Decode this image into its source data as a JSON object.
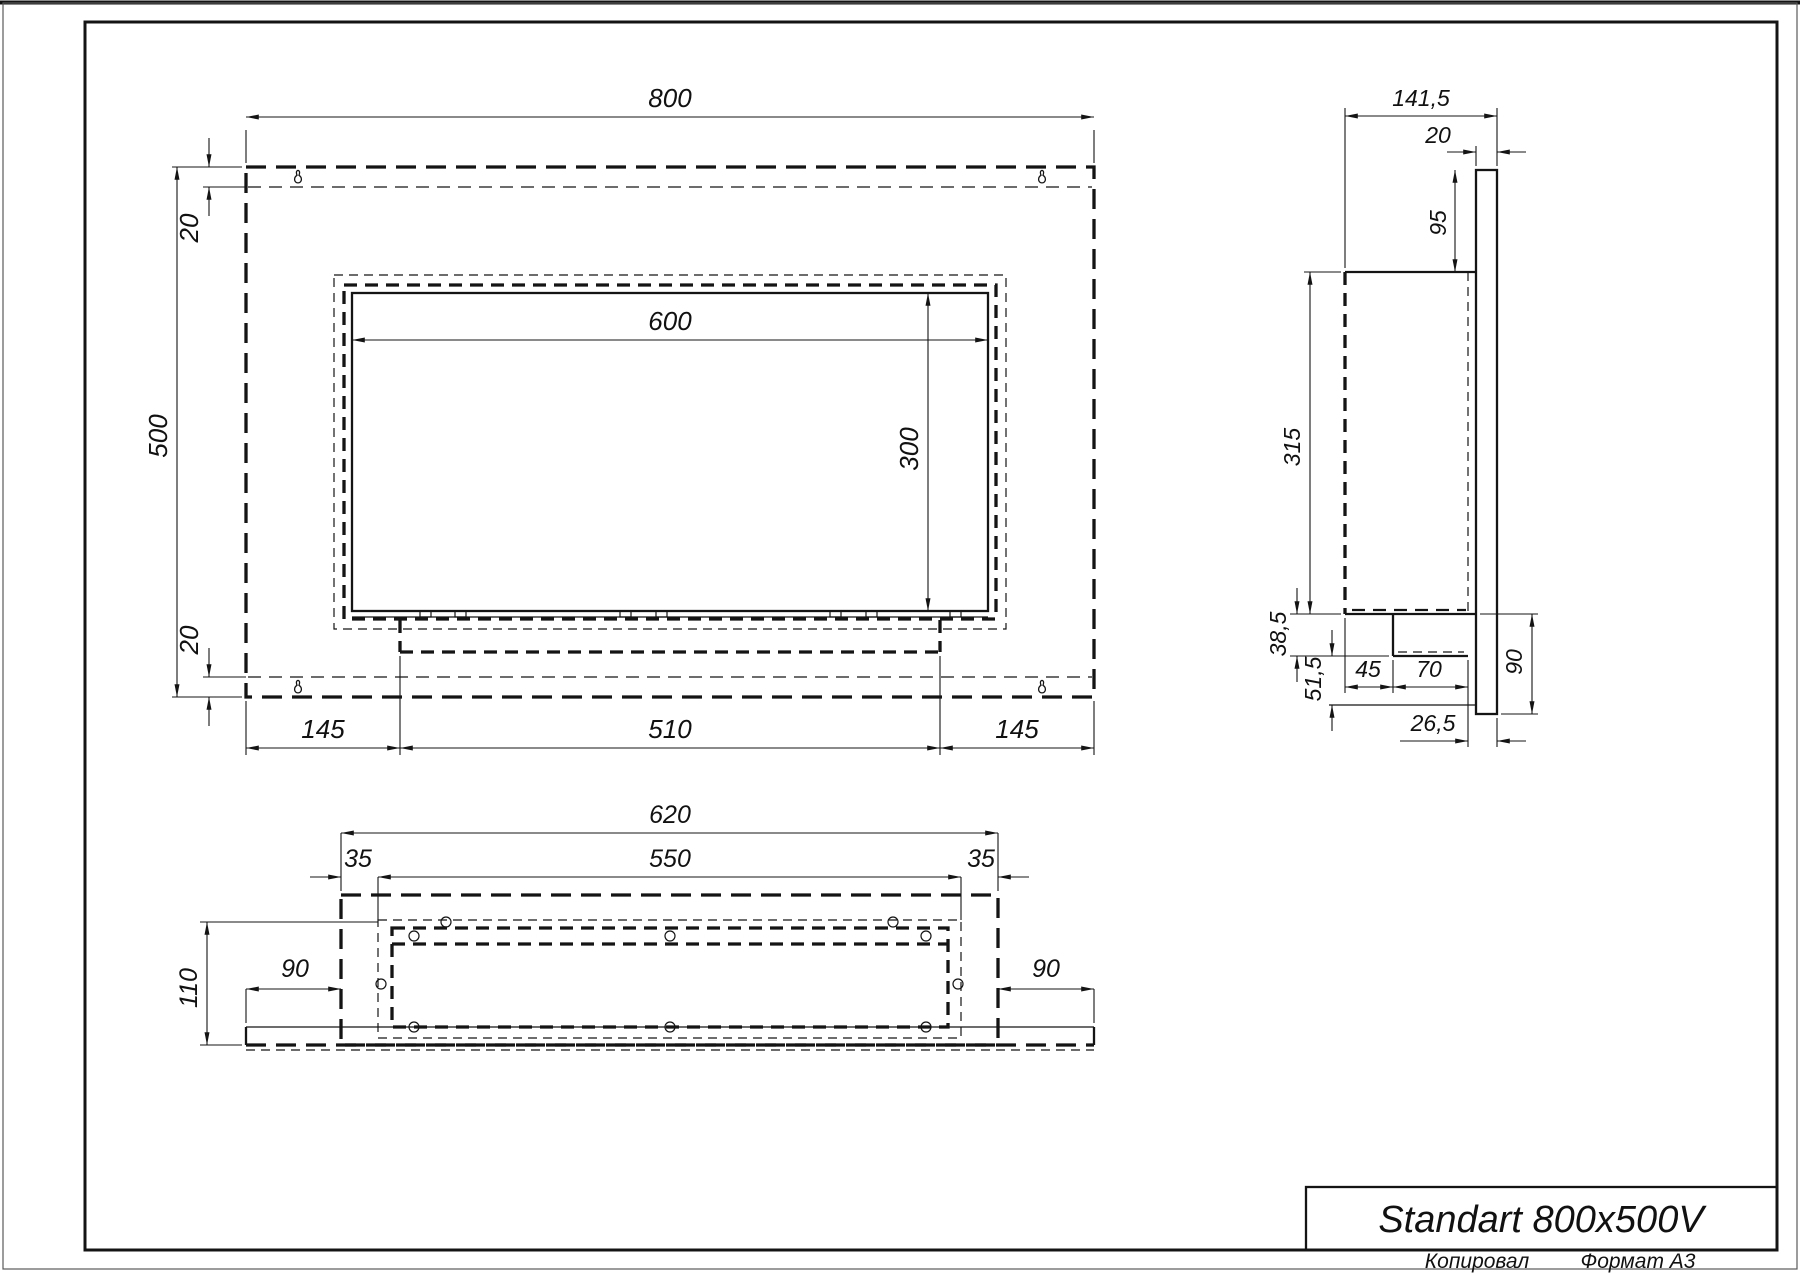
{
  "drawing": {
    "product_name": "Standart 800x500V",
    "views": {
      "front": {
        "dims": {
          "width": "800",
          "height": "500",
          "offset_top": "20",
          "offset_bottom": "20",
          "opening_width": "600",
          "opening_height": "300",
          "bottom_left_margin": "145",
          "burner_width": "510",
          "bottom_right_margin": "145"
        }
      },
      "side": {
        "dims": {
          "total_depth": "141,5",
          "wall_plate_width": "20",
          "plate_top_overhang": "95",
          "body_height": "315",
          "tray_height": "38,5",
          "lower_gap": "51,5",
          "tray_inset": "45",
          "tray_depth": "70",
          "lower_bracket_height": "90",
          "back_offset": "26,5"
        }
      },
      "bottom": {
        "dims": {
          "box_width": "620",
          "inner_width": "550",
          "left_inset": "35",
          "right_inset": "35",
          "depth": "110",
          "left_flange": "90",
          "right_flange": "90"
        }
      }
    },
    "title_block": {
      "title": "Standart 800x500V",
      "copied_label": "Копировал",
      "format_label": "Формат A3"
    }
  }
}
